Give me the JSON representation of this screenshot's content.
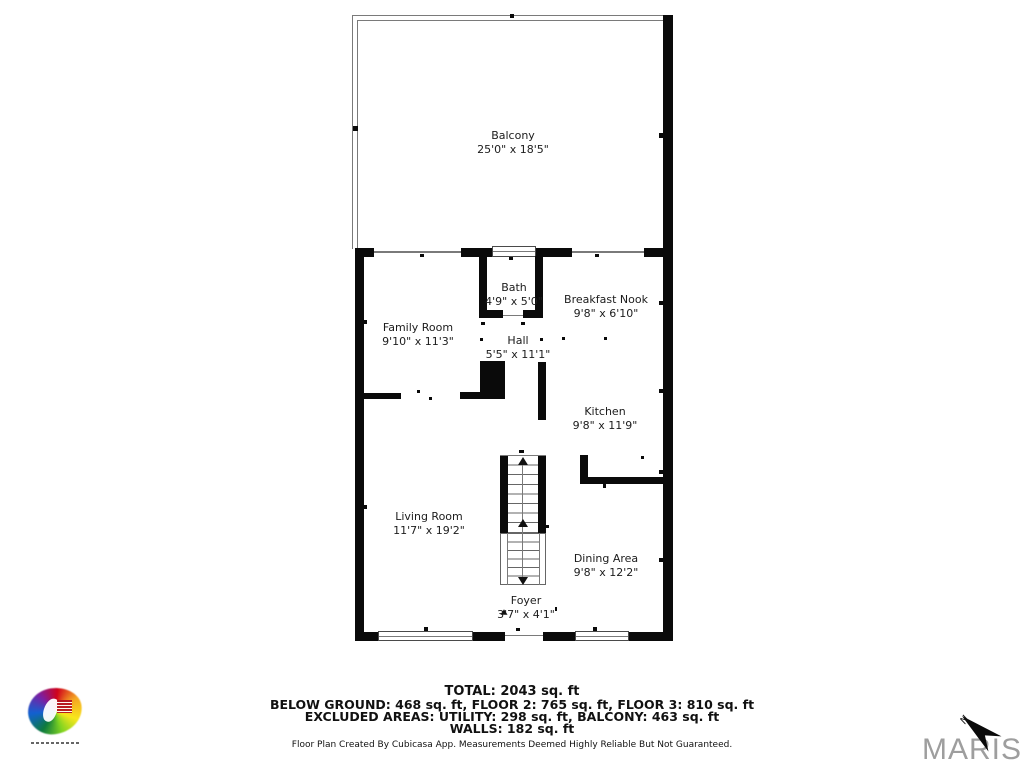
{
  "document": {
    "kind": "floor-plan screenshot"
  },
  "rooms": [
    {
      "name": "Balcony",
      "dims": "25'0\" x 18'5\""
    },
    {
      "name": "Bath",
      "dims": "4'9\" x 5'0\""
    },
    {
      "name": "Breakfast Nook",
      "dims": "9'8\" x 6'10\""
    },
    {
      "name": "Family Room",
      "dims": "9'10\" x 11'3\""
    },
    {
      "name": "Hall",
      "dims": "5'5\" x 11'1\""
    },
    {
      "name": "Kitchen",
      "dims": "9'8\" x 11'9\""
    },
    {
      "name": "Living Room",
      "dims": "11'7\" x 19'2\""
    },
    {
      "name": "Dining Area",
      "dims": "9'8\" x 12'2\""
    },
    {
      "name": "Foyer",
      "dims": "3'7\" x 4'1\""
    }
  ],
  "summary": {
    "total": "TOTAL: 2043 sq. ft",
    "line1": "BELOW GROUND: 468 sq. ft, FLOOR 2: 765 sq. ft, FLOOR 3: 810 sq. ft",
    "line2": "EXCLUDED AREAS: UTILITY: 298 sq. ft, BALCONY: 463 sq. ft",
    "line3": "WALLS: 182 sq. ft",
    "disclaimer": "Floor Plan Created By Cubicasa App. Measurements Deemed Highly Reliable But Not Guaranteed."
  },
  "branding": {
    "watermark": "MARIS",
    "compass_label": "N",
    "logo": "colorful-starburst-logo"
  },
  "colors": {
    "wall": "#0a0a0a",
    "railing": "#7a7a7a",
    "watermark_gray": "#9e9e9e"
  }
}
